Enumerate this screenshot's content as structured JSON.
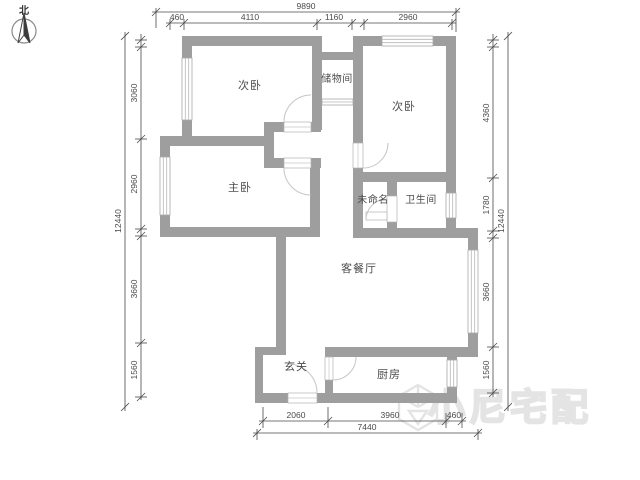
{
  "compass": {
    "label": "北"
  },
  "rooms": {
    "bedroom_left": {
      "label": "次卧"
    },
    "storage": {
      "label": "储物间"
    },
    "bedroom_right": {
      "label": "次卧"
    },
    "master": {
      "label": "主卧"
    },
    "unnamed": {
      "label": "未命名"
    },
    "bathroom": {
      "label": "卫生间"
    },
    "living_dining": {
      "label": "客餐厅"
    },
    "entry": {
      "label": "玄关"
    },
    "kitchen": {
      "label": "厨房"
    }
  },
  "dimensions": {
    "top": {
      "total": "9890",
      "segments": [
        "460",
        "4110",
        "1160",
        "2960"
      ]
    },
    "left": {
      "total": "12440",
      "segments": [
        "3060",
        "2960",
        "3660",
        "1560"
      ]
    },
    "right": {
      "total": "12440",
      "segments": [
        "4360",
        "1780",
        "3660",
        "1560"
      ]
    },
    "bottom": {
      "total": "7440",
      "segments": [
        "2060",
        "3960",
        "460"
      ]
    }
  },
  "watermark": {
    "text": "小尼宅配"
  },
  "colors": {
    "wall": "#9e9e9e",
    "dim_line": "#4a4a4a",
    "room_label": "#4c4c4c",
    "door_arc": "#c6c6c6",
    "watermark_stroke": "#e4e4e4",
    "background": "#ffffff"
  }
}
